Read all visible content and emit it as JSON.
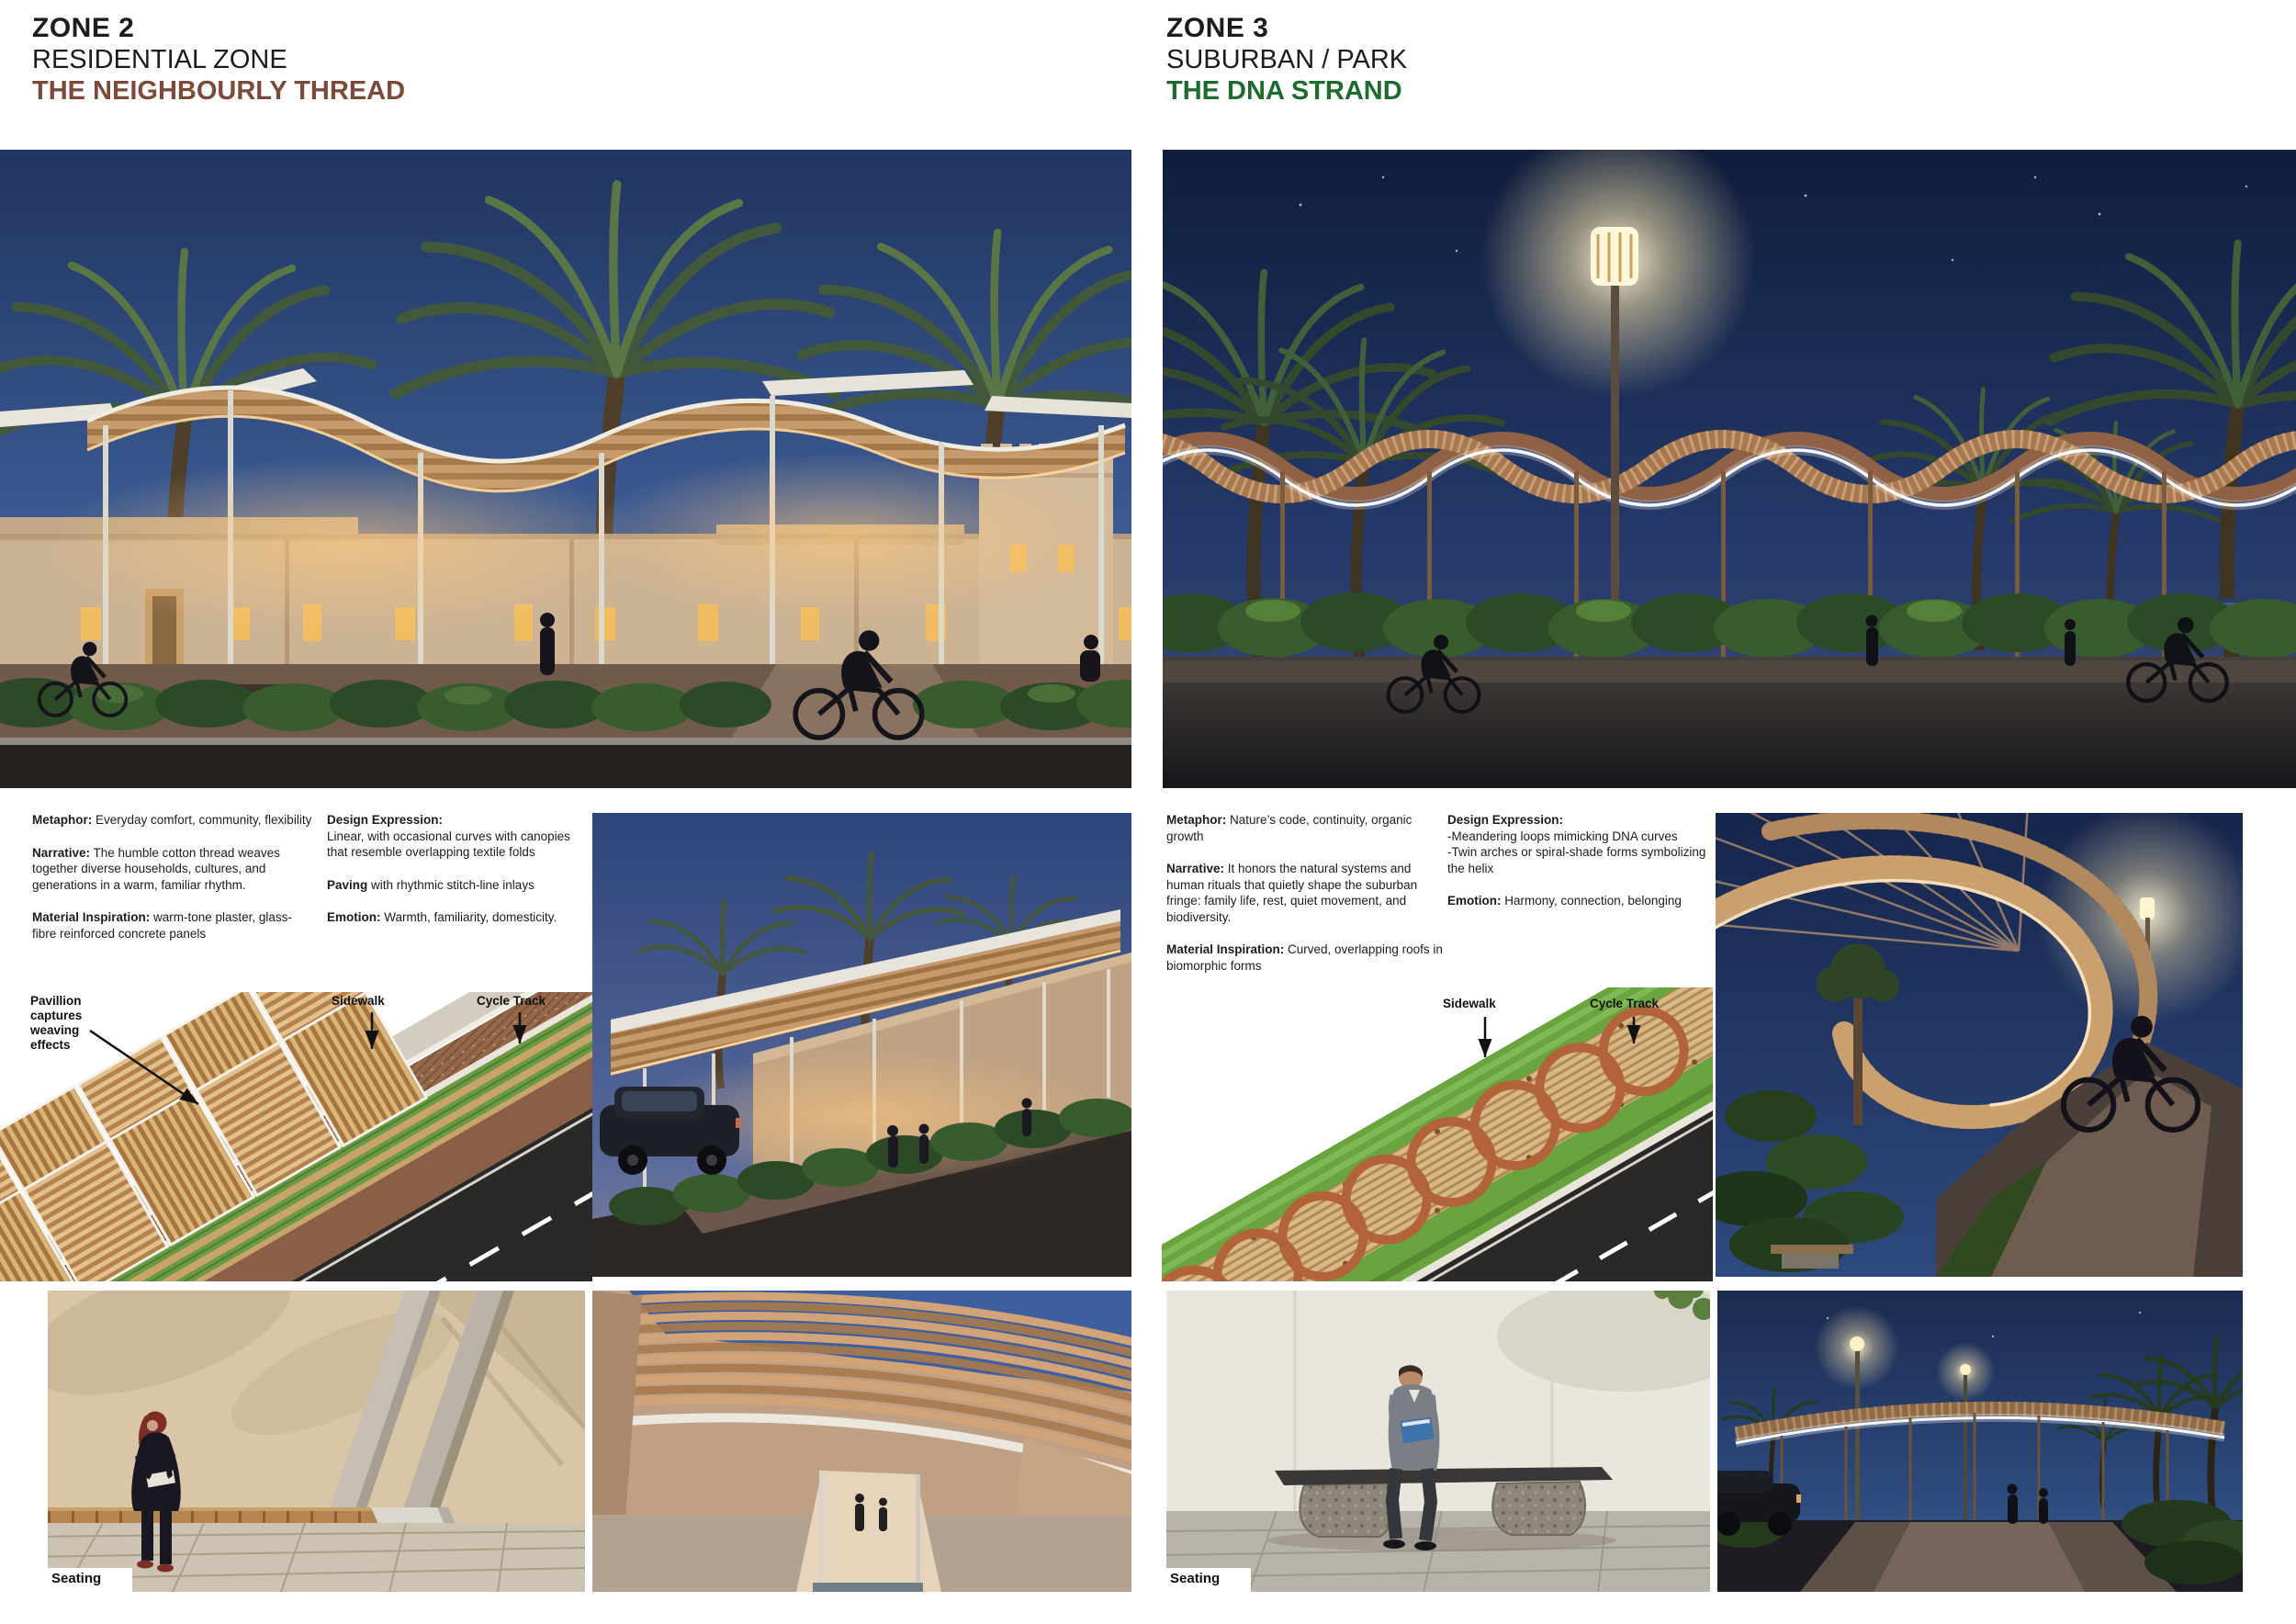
{
  "board": {
    "background": "#ffffff"
  },
  "zones": [
    {
      "name": "ZONE 2",
      "subtitle": "RESIDENTIAL ZONE",
      "theme": "THE NEIGHBOURLY THREAD",
      "theme_color": "#7d4a3a",
      "text_col1": [
        {
          "label": "Metaphor:",
          "inline": true,
          "lines": [
            "Everyday comfort, community, flexibility"
          ]
        },
        {
          "label": "Narrative:",
          "inline": true,
          "lines": [
            "The humble cotton thread weaves together diverse households, cultures, and generations in a warm, familiar rhythm."
          ]
        },
        {
          "label": "Material Inspiration:",
          "inline": true,
          "lines": [
            "warm-tone plaster, glass-fibre reinforced concrete panels"
          ]
        }
      ],
      "text_col2": [
        {
          "label": "Design Expression:",
          "inline": false,
          "lines": [
            "Linear, with occasional curves with canopies that resemble overlapping textile folds"
          ]
        },
        {
          "label": "Paving",
          "inline": true,
          "lines": [
            "with rhythmic stitch-line inlays"
          ]
        },
        {
          "label": "Emotion:",
          "inline": true,
          "lines": [
            "Warmth, familiarity, domesticity."
          ]
        }
      ],
      "diagram": {
        "callout": "Pavillion captures weaving effects",
        "sidewalk": "Sidewalk",
        "cycle_track": "Cycle Track"
      },
      "seating": "Seating"
    },
    {
      "name": "ZONE 3",
      "subtitle": "SUBURBAN / PARK",
      "theme": "THE DNA STRAND",
      "theme_color": "#1e6b2f",
      "text_col1": [
        {
          "label": "Metaphor:",
          "inline": true,
          "lines": [
            "Nature’s code, continuity, organic growth"
          ]
        },
        {
          "label": "Narrative:",
          "inline": true,
          "lines": [
            "It honors the natural systems and human rituals that quietly shape the suburban fringe: family life, rest, quiet movement, and biodiversity."
          ]
        },
        {
          "label": "Material Inspiration:",
          "inline": true,
          "lines": [
            "Curved, overlapping roofs in biomorphic forms"
          ]
        }
      ],
      "text_col2": [
        {
          "label": "Design Expression:",
          "inline": false,
          "lines": [
            "-Meandering loops mimicking DNA curves",
            "-Twin arches or spiral-shade forms symbolizing the helix"
          ]
        },
        {
          "label": "Emotion:",
          "inline": true,
          "lines": [
            "Harmony, connection, belonging"
          ]
        }
      ],
      "diagram": {
        "sidewalk": "Sidewalk",
        "cycle_track": "Cycle Track"
      },
      "seating": "Seating"
    }
  ]
}
